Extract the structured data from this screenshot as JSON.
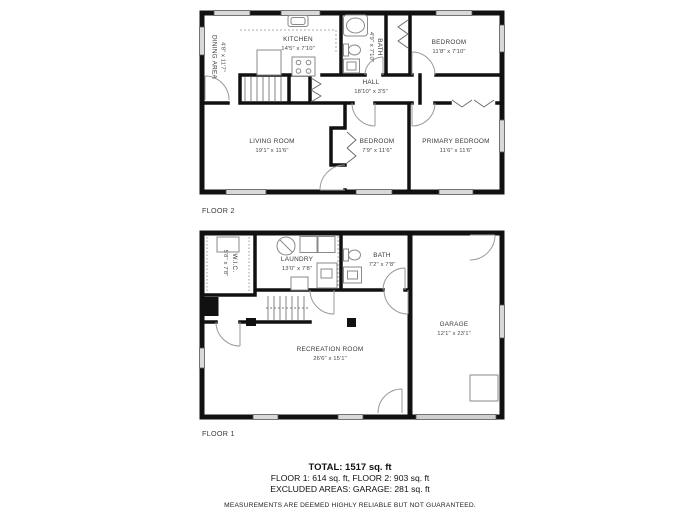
{
  "floors": [
    {
      "label": "FLOOR 2",
      "rooms": [
        {
          "name": "DINING AREA",
          "dims": "4'8\" x 11'7\""
        },
        {
          "name": "KITCHEN",
          "dims": "14'5\" x 7'10\""
        },
        {
          "name": "BATH",
          "dims": "4'9\" x 7'10\""
        },
        {
          "name": "BEDROOM",
          "dims": "11'8\" x 7'10\""
        },
        {
          "name": "HALL",
          "dims": "18'10\" x 3'5\""
        },
        {
          "name": "LIVING ROOM",
          "dims": "19'1\" x 11'6\""
        },
        {
          "name": "BEDROOM",
          "dims": "7'9\" x 11'6\""
        },
        {
          "name": "PRIMARY BEDROOM",
          "dims": "11'6\" x 11'6\""
        }
      ]
    },
    {
      "label": "FLOOR 1",
      "rooms": [
        {
          "name": "W.I.C.",
          "dims": "5'8\" x 7'8\""
        },
        {
          "name": "LAUNDRY",
          "dims": "13'0\" x 7'8\""
        },
        {
          "name": "BATH",
          "dims": "7'2\" x 7'8\""
        },
        {
          "name": "GARAGE",
          "dims": "12'1\" x 23'1\""
        },
        {
          "name": "RECREATION ROOM",
          "dims": "26'6\" x 15'1\""
        }
      ]
    }
  ],
  "summary": {
    "total": "TOTAL: 1517 sq. ft",
    "floors_line": "FLOOR 1: 614 sq. ft, FLOOR 2: 903 sq. ft",
    "excluded_line": "EXCLUDED AREAS: GARAGE: 281 sq. ft",
    "disclaimer": "MEASUREMENTS ARE DEEMED HIGHLY RELIABLE BUT NOT GUARANTEED."
  },
  "colors": {
    "wall": "#111111",
    "window_fill": "#d9d9d9",
    "fixture": "#8a8a8a",
    "door": "#999999"
  }
}
